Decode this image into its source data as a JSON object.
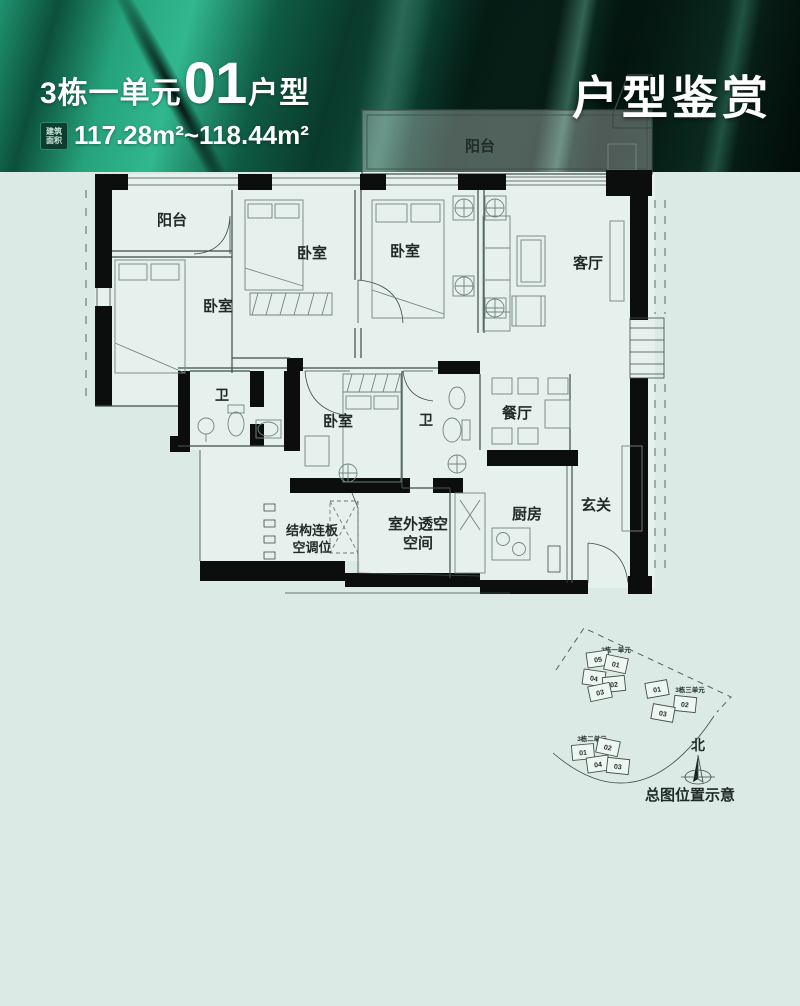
{
  "banner": {
    "unit_prefix": "3栋一单元",
    "unit_number": "01",
    "unit_suffix": "户型",
    "badge_line1": "建筑",
    "badge_line2": "面积",
    "area_text": "117.28m²~118.44m²",
    "right_title": "户型鉴赏"
  },
  "colors": {
    "page_background": "#dceae5",
    "banner_bright_green": "#31b78e",
    "banner_dark_green": "#04150f",
    "wall_black": "#0c0e0d",
    "text_dark": "#1f2b27"
  },
  "floorplan": {
    "labels": {
      "balcony_top": "阳台",
      "balcony_left": "阳台",
      "bedroom_left": "卧室",
      "bedroom_2": "卧室",
      "bedroom_3": "卧室",
      "living": "客厅",
      "bath_1": "卫",
      "bedroom_4": "卧室",
      "bath_2": "卫",
      "dining": "餐厅",
      "kitchen": "厨房",
      "entry": "玄关",
      "ac_line1": "结构连板",
      "ac_line2": "空调位",
      "void_line1": "室外透空",
      "void_line2": "空间"
    }
  },
  "siteplan": {
    "clusters": [
      {
        "name": "3栋一单元",
        "units": [
          "05",
          "01",
          "04",
          "02",
          "03"
        ],
        "highlighted_unit": "01"
      },
      {
        "name": "3栋三单元",
        "units": [
          "01",
          "02",
          "03"
        ]
      },
      {
        "name": "3栋二单元",
        "units": [
          "01",
          "02",
          "04",
          "03"
        ]
      }
    ],
    "north_label": "北",
    "caption": "总图位置示意"
  }
}
